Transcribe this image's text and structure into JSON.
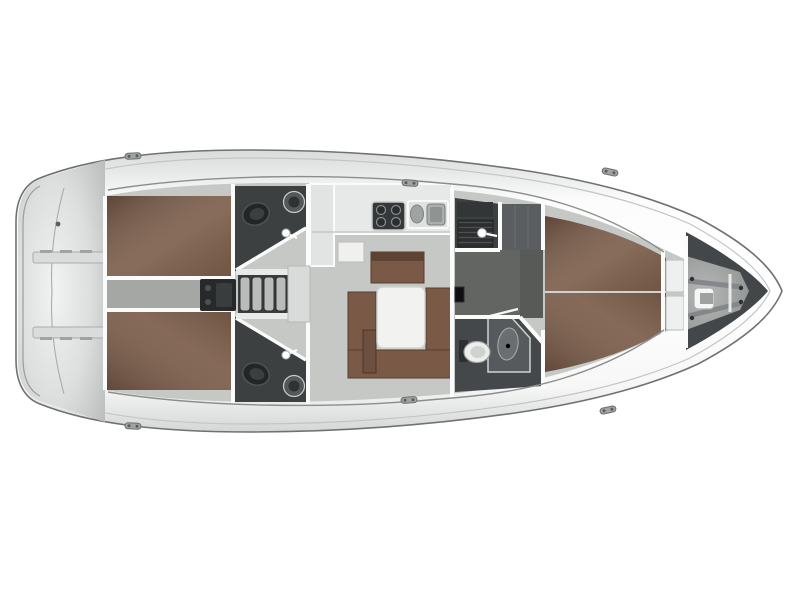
{
  "diagram": {
    "type": "sailboat-interior-deck-plan",
    "view": "top-down",
    "orientation": "bow-right-stern-left"
  },
  "palette": {
    "background": "#ffffff",
    "hull_outline": "#6f7271",
    "deck_seam": "#c2c5c4",
    "interior_floor": "#c6c8c5",
    "engine_room_floor": "#a4a7a4",
    "corridor_floor": "#626561",
    "berth_brown": "#7b5c49",
    "settee_brown": "#7a5a47",
    "wood_dark": "#553d2d",
    "table_white": "#f2f3f1",
    "wetroom_dark": "#3d4041",
    "forward_head_dark": "#45484b",
    "fixture_light": "#e9ebea",
    "steel_gray": "#b0b4b3",
    "engine_dark": "#27292a",
    "step_tread": "#b9bcbb",
    "bow_dark": "#44474a",
    "hatch_cover": "#d8dbda"
  },
  "areas": {
    "hull": {
      "label": "Sailing yacht hull - interior layout plan, bow to the right"
    },
    "transom": {
      "label": "Transom with swim platform"
    },
    "swim_step_upper": {
      "label": "Transom boarding step (port)"
    },
    "swim_step_lower": {
      "label": "Transom boarding step (starboard)"
    },
    "aft_cabin_port": {
      "label": "Aft cabin double berth (port)"
    },
    "aft_cabin_starboard": {
      "label": "Aft cabin double berth (starboard)"
    },
    "engine_room": {
      "label": "Engine compartment under companionway"
    },
    "companionway": {
      "label": "Companionway steps"
    },
    "hatch_garage": {
      "label": "Companionway hatch"
    },
    "head_aft_port": {
      "label": "Aft head with shower (port)"
    },
    "head_aft_starboard": {
      "label": "Aft head with shower (starboard)"
    },
    "galley": {
      "label": "Galley worktop"
    },
    "stove": {
      "label": "Galley stove with four burners"
    },
    "sink": {
      "label": "Twin galley sinks"
    },
    "chart_table": {
      "label": "Chart table"
    },
    "salon": {
      "label": "Salon"
    },
    "salon_table": {
      "label": "Salon table"
    },
    "settee": {
      "label": "U-shaped salon settee"
    },
    "aft_bench": {
      "label": "Salon bench seat"
    },
    "stool": {
      "label": "Salon stool seat"
    },
    "shower_room": {
      "label": "Forward shower compartment"
    },
    "wardrobe": {
      "label": "Wardrobe locker"
    },
    "corridor": {
      "label": "Passage to forward cabin"
    },
    "head_forward": {
      "label": "Forward head with shower stall"
    },
    "forward_cabin": {
      "label": "Forward cabin V-berth"
    },
    "berth_foot_lockers": {
      "label": "Lockers at berth foot"
    },
    "bow_locker": {
      "label": "Bow anchor locker"
    },
    "windlass": {
      "label": "Anchor windlass frame"
    },
    "cleat": {
      "label": "Mooring cleat"
    }
  }
}
